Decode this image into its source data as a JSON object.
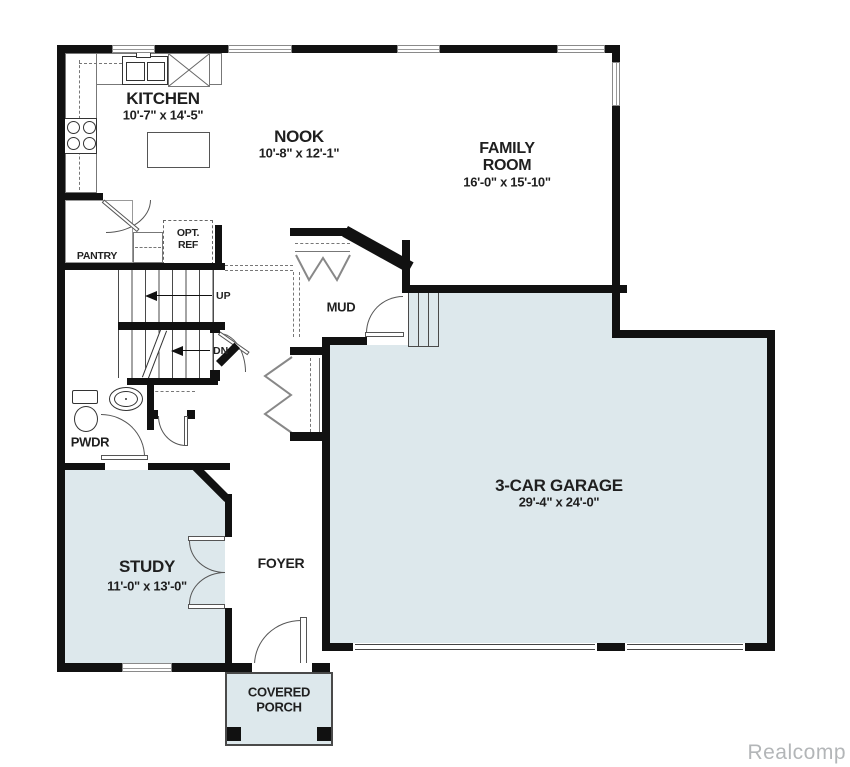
{
  "watermark": {
    "text": "Realcomp"
  },
  "colors": {
    "wall": "#111111",
    "room_fill": "#dde8ec",
    "label": "#1f1f1f",
    "watermark": "#b3b6b8"
  },
  "rooms": {
    "kitchen": {
      "name": "KITCHEN",
      "dims": "10'-7\" x 14'-5\""
    },
    "nook": {
      "name": "NOOK",
      "dims": "10'-8\" x 12'-1\""
    },
    "family_room": {
      "line1": "FAMILY",
      "line2": "ROOM",
      "dims": "16'-0\" x 15'-10\""
    },
    "garage": {
      "name": "3-CAR GARAGE",
      "dims": "29'-4\" x 24'-0\""
    },
    "study": {
      "name": "STUDY",
      "dims": "11'-0\" x 13'-0\""
    },
    "foyer": {
      "name": "FOYER"
    },
    "mud": {
      "name": "MUD"
    },
    "pwdr": {
      "name": "PWDR"
    },
    "pantry": {
      "name": "PANTRY"
    },
    "opt_ref": {
      "line1": "OPT.",
      "line2": "REF"
    },
    "covered_porch": {
      "line1": "COVERED",
      "line2": "PORCH"
    }
  },
  "stairs": {
    "up_label": "UP",
    "dn_label": "DN"
  }
}
